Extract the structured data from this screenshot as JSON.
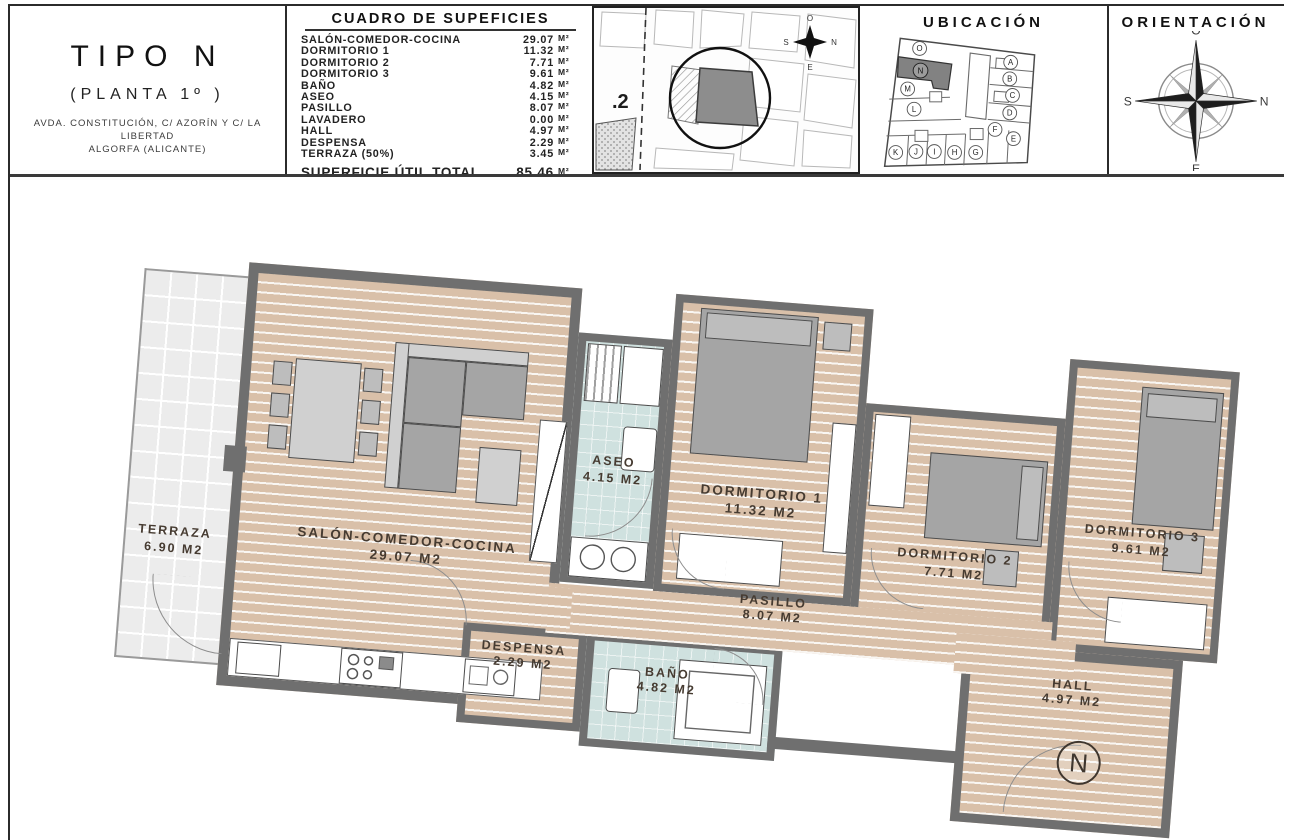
{
  "header": {
    "title_block": {
      "title": "TIPO N",
      "subtitle": "(PLANTA 1º )",
      "address_line1": "AVDA. CONSTITUCIÓN, C/ AZORÍN Y C/ LA LIBERTAD",
      "address_line2": "ALGORFA (ALICANTE)"
    },
    "surface_table": {
      "title": "CUADRO DE SUPEFICIES",
      "rows": [
        {
          "label": "SALÓN-COMEDOR-COCINA",
          "value": "29.07",
          "unit": "M²"
        },
        {
          "label": "DORMITORIO 1",
          "value": "11.32",
          "unit": "M²"
        },
        {
          "label": "DORMITORIO 2",
          "value": "7.71",
          "unit": "M²"
        },
        {
          "label": "DORMITORIO 3",
          "value": "9.61",
          "unit": "M²"
        },
        {
          "label": "BAÑO",
          "value": "4.82",
          "unit": "M²"
        },
        {
          "label": "ASEO",
          "value": "4.15",
          "unit": "M²"
        },
        {
          "label": "PASILLO",
          "value": "8.07",
          "unit": "M²"
        },
        {
          "label": "LAVADERO",
          "value": "0.00",
          "unit": "M²"
        },
        {
          "label": "HALL",
          "value": "4.97",
          "unit": "M²"
        },
        {
          "label": "DESPENSA",
          "value": "2.29",
          "unit": "M²"
        },
        {
          "label": "TERRAZA (50%)",
          "value": "3.45",
          "unit": "M²"
        }
      ],
      "total": {
        "label": "SUPERFICIE ÚTIL TOTAL",
        "value": "85.46",
        "unit": "M²"
      },
      "terraza_total": {
        "label": "TERRAZA (100%)",
        "value": "6.90",
        "unit": "M²"
      }
    },
    "site_plan": {
      "plot_label": ".2",
      "compass": {
        "top": "O",
        "right": "N",
        "left": "S",
        "bottom": "E"
      }
    },
    "ubicacion": {
      "title": "UBICACIÓN",
      "highlighted_unit": "N",
      "units": [
        "A",
        "B",
        "C",
        "D",
        "E",
        "F",
        "G",
        "H",
        "I",
        "J",
        "K",
        "L",
        "M",
        "N",
        "O"
      ]
    },
    "orientacion": {
      "title": "ORIENTACIÓN",
      "compass": {
        "top": "O",
        "right": "N",
        "left": "S",
        "bottom": "E"
      }
    }
  },
  "plan": {
    "entrance_badge": "N",
    "rooms": [
      {
        "id": "terraza",
        "name": "TERRAZA",
        "area": "6.90 M2"
      },
      {
        "id": "salon",
        "name": "SALÓN-COMEDOR-COCINA",
        "area": "29.07 M2"
      },
      {
        "id": "aseo",
        "name": "ASEO",
        "area": "4.15 M2"
      },
      {
        "id": "dorm1",
        "name": "DORMITORIO 1",
        "area": "11.32 M2"
      },
      {
        "id": "dorm2",
        "name": "DORMITORIO 2",
        "area": "7.71 M2"
      },
      {
        "id": "dorm3",
        "name": "DORMITORIO 3",
        "area": "9.61 M2"
      },
      {
        "id": "pasillo",
        "name": "PASILLO",
        "area": "8.07 M2"
      },
      {
        "id": "despensa",
        "name": "DESPENSA",
        "area": "2.29 M2"
      },
      {
        "id": "bano",
        "name": "BAÑO",
        "area": "4.82 M2"
      },
      {
        "id": "hall",
        "name": "HALL",
        "area": "4.97 M2"
      }
    ]
  }
}
